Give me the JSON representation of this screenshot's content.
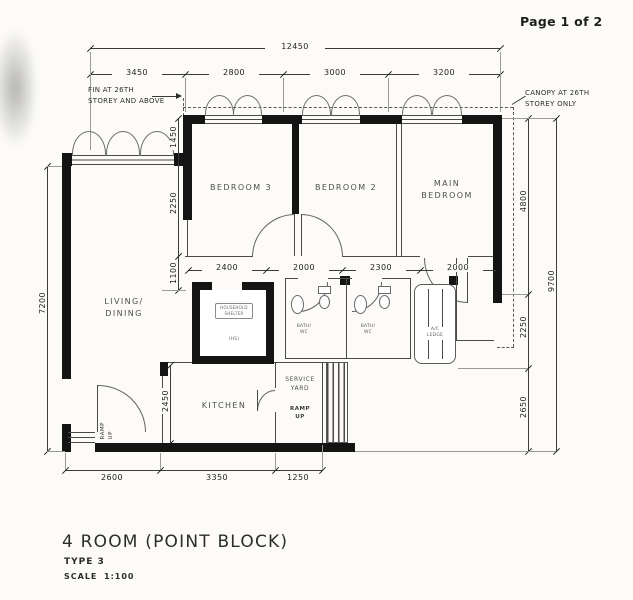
{
  "page": {
    "number": "Page 1 of 2"
  },
  "title_block": {
    "title": "4 ROOM (POINT BLOCK)",
    "type": "TYPE 3",
    "scale_label": "SCALE",
    "scale_value": "1:100"
  },
  "notes": {
    "fin": "FIN AT 26TH\nSTOREY AND ABOVE",
    "canopy": "CANOPY AT 26TH\nSTOREY ONLY"
  },
  "rooms": {
    "bedroom3": "BEDROOM 3",
    "bedroom2": "BEDROOM 2",
    "main_bedroom": "MAIN\nBEDROOM",
    "living": "LIVING/\nDINING",
    "kitchen": "KITCHEN",
    "service_yard": "SERVICE\nYARD",
    "bath1": "BATH/\nWC",
    "bath2": "BATH/\nWC",
    "ac_ledge": "A/C\nLEDGE",
    "shelter": "HOUSEHOLD\nSHELTER",
    "shelter_tag": "(HS)"
  },
  "annotations": {
    "ramp_up_entrance": "RAMP\nUP",
    "ramp_up_service": "RAMP\nUP"
  },
  "dimensions": {
    "top_total": "12450",
    "top": [
      "3450",
      "2800",
      "3000",
      "3200"
    ],
    "mid": [
      "2400",
      "2000",
      "2300",
      "2000"
    ],
    "bottom": [
      "2600",
      "3350",
      "1250"
    ],
    "left_outer": "7200",
    "left_chain": [
      "1450",
      "2250",
      "1100"
    ],
    "kitchen_height": "2450",
    "right_outer": "9700",
    "right_chain": [
      "4800",
      "2250",
      "2650"
    ]
  },
  "colors": {
    "paper": "#fcfbf8",
    "ink": "#2f2f2f",
    "wall": "#141414"
  }
}
